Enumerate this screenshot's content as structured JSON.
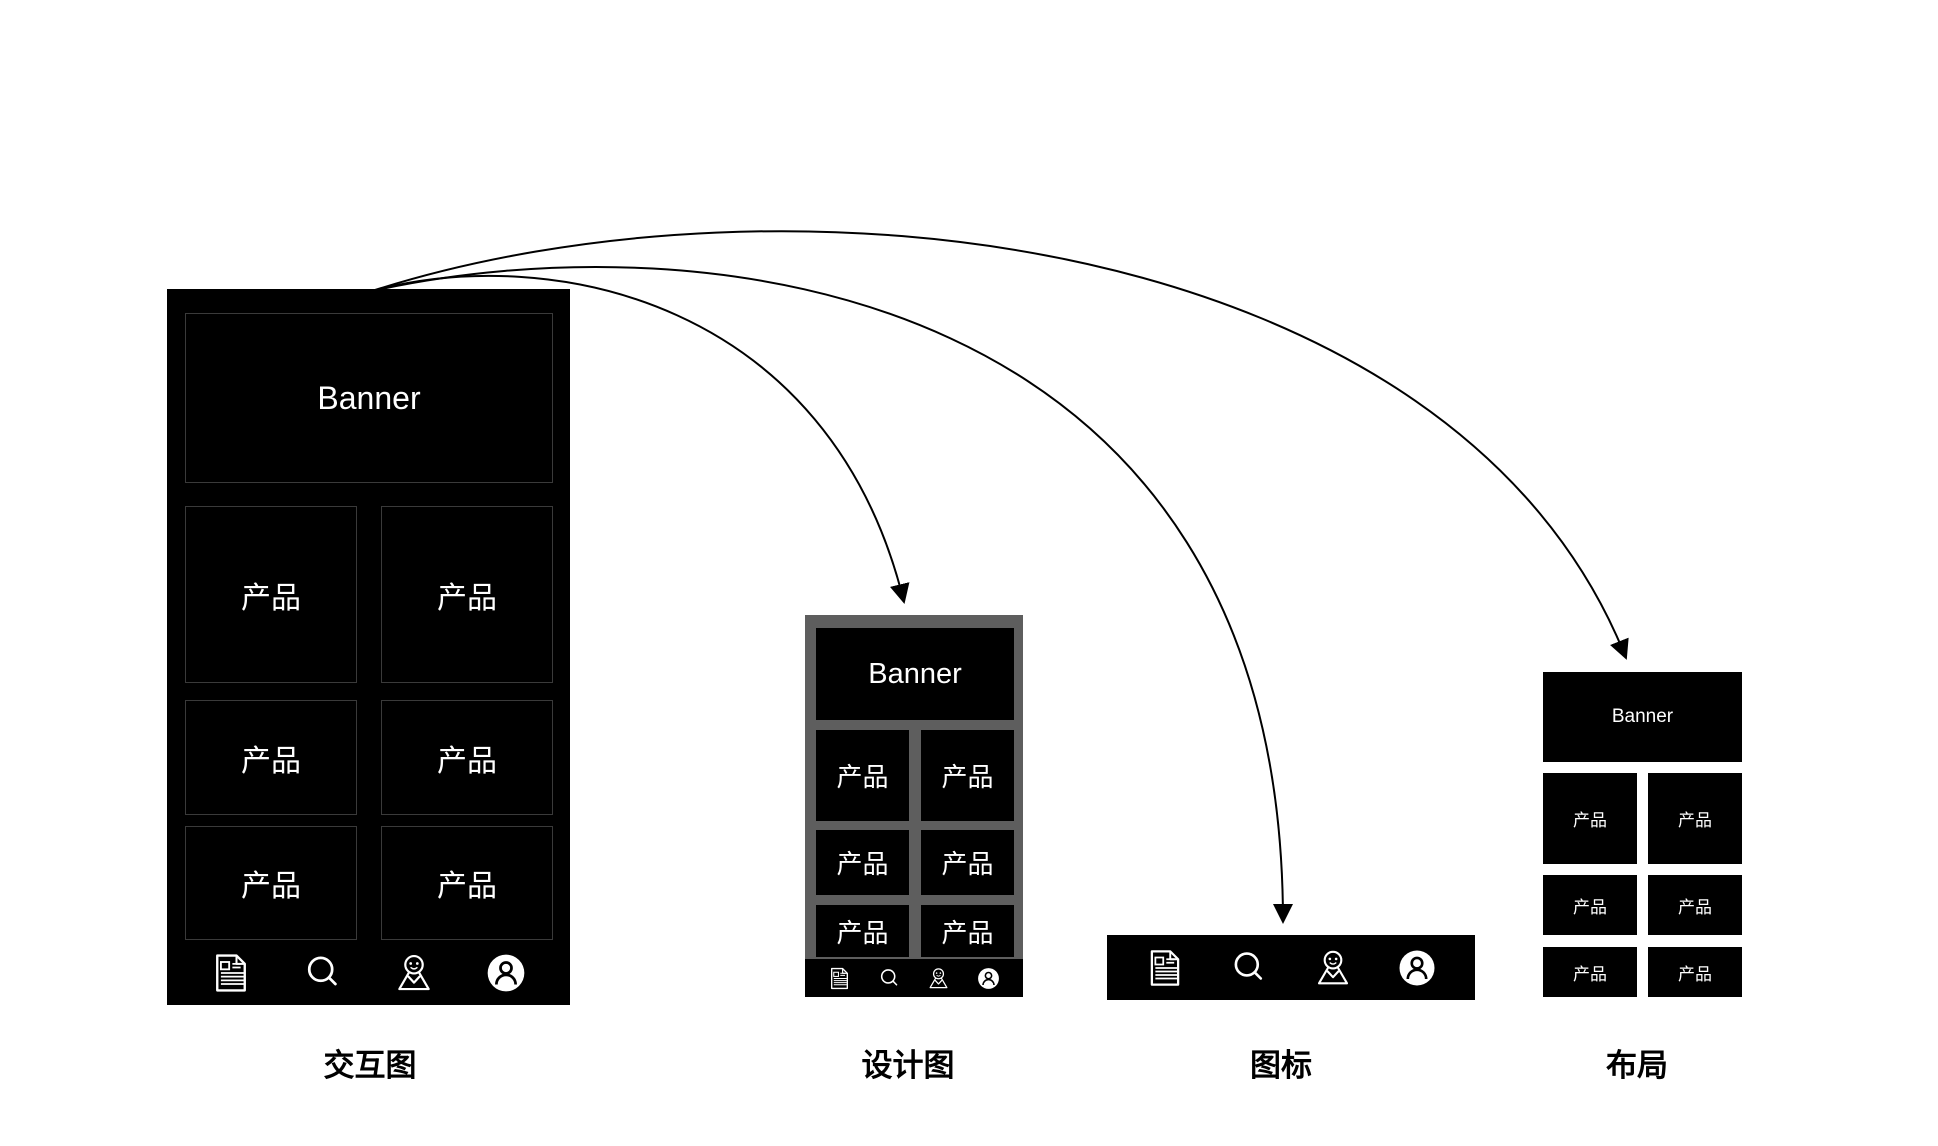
{
  "diagram": {
    "banner_label": "Banner",
    "product_label": "产品",
    "captions": {
      "interaction": "交互图",
      "design": "设计图",
      "icons": "图标",
      "layout": "布局"
    },
    "icon_names": [
      "document-icon",
      "search-icon",
      "map-pin-mascot-icon",
      "user-icon"
    ],
    "colors": {
      "background": "#ffffff",
      "mockup_black": "#000000",
      "design_frame_gray": "#5e5e5e",
      "cell_border_gray": "#3a3a3a",
      "text_white": "#ffffff",
      "caption_black": "#000000",
      "arrow_black": "#000000"
    }
  }
}
